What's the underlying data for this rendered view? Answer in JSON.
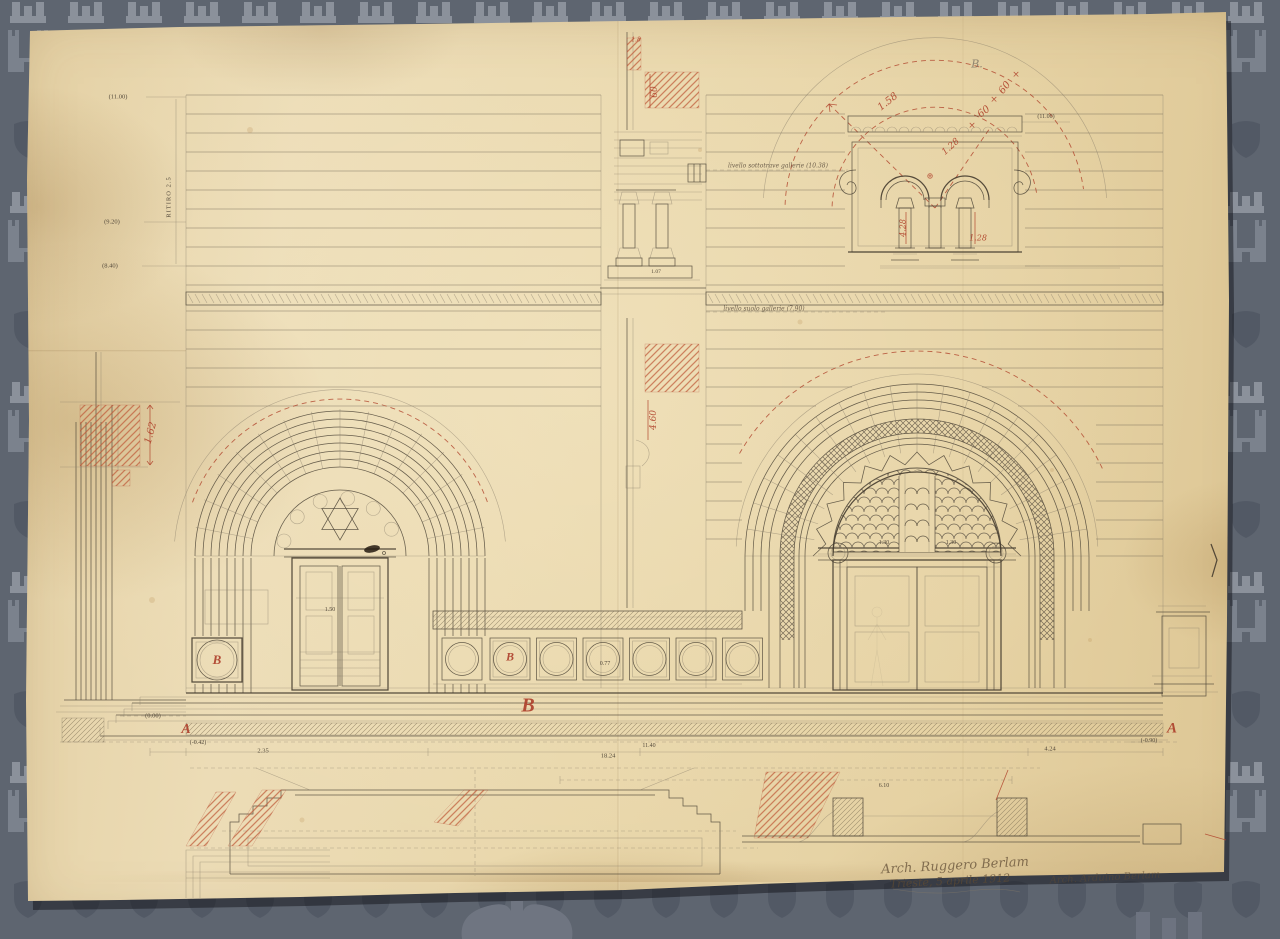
{
  "colors": {
    "backdrop": "#5e6570",
    "watermark_light": "#8b919b",
    "watermark_mid": "#7b828d",
    "watermark_dark": "#525965",
    "paper": "#e9d7ab",
    "ink": "#4e4537",
    "red_ink": "#b0432c",
    "pencil": "#857a68"
  },
  "annotations": [
    {
      "id": "level-11-00-left",
      "t": "(11.00)",
      "x": 118,
      "y": 97,
      "k": "level"
    },
    {
      "id": "ritiro-note",
      "t": "RITIRO 2.5",
      "x": 169,
      "y": 197,
      "k": "level",
      "r": -90,
      "ls": 1
    },
    {
      "id": "level-9-20",
      "t": "(9.20)",
      "x": 112,
      "y": 222,
      "k": "level"
    },
    {
      "id": "level-8-40-left",
      "t": "(8.40)",
      "x": 110,
      "y": 266,
      "k": "level"
    },
    {
      "id": "dim-1-62",
      "t": "1.62",
      "x": 151,
      "y": 433,
      "k": "red",
      "r": -75,
      "s": 10
    },
    {
      "id": "level-0-00",
      "t": "(0.00)",
      "x": 153,
      "y": 716,
      "k": "level"
    },
    {
      "id": "section-letter-a-left",
      "t": "A",
      "x": 186,
      "y": 730,
      "k": "letter",
      "s": 14
    },
    {
      "id": "level-minus-0-42",
      "t": "(-0.42)",
      "x": 198,
      "y": 743,
      "k": "level",
      "s": 6
    },
    {
      "id": "dim-2-35",
      "t": "2.35",
      "x": 263,
      "y": 751,
      "k": "level"
    },
    {
      "id": "dim-18-24",
      "t": "18.24",
      "x": 608,
      "y": 756,
      "k": "level"
    },
    {
      "id": "dim-11-40",
      "t": "11.40",
      "x": 649,
      "y": 746,
      "k": "level",
      "s": 6
    },
    {
      "id": "dim-4-24",
      "t": "4.24",
      "x": 1050,
      "y": 749,
      "k": "level"
    },
    {
      "id": "level-minus-0-90",
      "t": "(-0.90)",
      "x": 1149,
      "y": 741,
      "k": "level",
      "s": 6
    },
    {
      "id": "section-letter-a-right",
      "t": "A",
      "x": 1172,
      "y": 729,
      "k": "letter",
      "s": 15
    },
    {
      "id": "zone-letter-b-large",
      "t": "B",
      "x": 528,
      "y": 706,
      "k": "letter",
      "s": 20
    },
    {
      "id": "medallion-letter-b",
      "t": "B",
      "x": 510,
      "y": 657,
      "k": "letter",
      "s": 12
    },
    {
      "id": "medallion-letter-b-left",
      "t": "B",
      "x": 217,
      "y": 660,
      "k": "letter",
      "s": 13
    },
    {
      "id": "detail-label-b",
      "t": "B.",
      "x": 977,
      "y": 64,
      "k": "pencil",
      "s": 11
    },
    {
      "id": "dim-1-58",
      "t": "1.58",
      "x": 888,
      "y": 102,
      "k": "red",
      "r": -38,
      "s": 10
    },
    {
      "id": "dim-60-upper",
      "t": "60",
      "x": 1005,
      "y": 88,
      "k": "red",
      "r": -52,
      "s": 10
    },
    {
      "id": "dim-60-lower",
      "t": "60",
      "x": 984,
      "y": 112,
      "k": "red",
      "r": -38,
      "s": 10
    },
    {
      "id": "dim-1-28-radial",
      "t": "1.28",
      "x": 951,
      "y": 147,
      "k": "red",
      "r": -42,
      "s": 9
    },
    {
      "id": "dim-1-28-column",
      "t": "1.28",
      "x": 978,
      "y": 238,
      "k": "red",
      "s": 8
    },
    {
      "id": "dim-4-28-column",
      "t": "4.28",
      "x": 903,
      "y": 228,
      "k": "red",
      "r": -90,
      "s": 8
    },
    {
      "id": "level-11-00-right",
      "t": "(11.00)",
      "x": 1046,
      "y": 117,
      "k": "level",
      "s": 6
    },
    {
      "id": "note-livello-sottotrave",
      "t": "livello sottotrave gallerie (10.38)",
      "x": 778,
      "y": 166,
      "k": "note"
    },
    {
      "id": "note-livello-suolo",
      "t": "livello suolo gallerie (7.90)",
      "x": 764,
      "y": 309,
      "k": "note"
    },
    {
      "id": "dim-4-60",
      "t": "4.60",
      "x": 654,
      "y": 420,
      "k": "red",
      "r": -90,
      "s": 9
    },
    {
      "id": "dim-60-section",
      "t": "60",
      "x": 655,
      "y": 92,
      "k": "red",
      "r": -90,
      "s": 9
    },
    {
      "id": "dim-1-8-section",
      "t": "1.8",
      "x": 636,
      "y": 40,
      "k": "red",
      "s": 6
    },
    {
      "id": "dim-1-30-left",
      "t": "1.30",
      "x": 884,
      "y": 543,
      "k": "level",
      "s": 6
    },
    {
      "id": "dim-1-30-right",
      "t": "1.30",
      "x": 951,
      "y": 543,
      "k": "level",
      "s": 6
    },
    {
      "id": "dim-0-77",
      "t": "0.77",
      "x": 605,
      "y": 664,
      "k": "level",
      "s": 6
    },
    {
      "id": "dim-6-10",
      "t": "6.10",
      "x": 884,
      "y": 786,
      "k": "level",
      "s": 6
    },
    {
      "id": "dim-1-07",
      "t": "1.07",
      "x": 656,
      "y": 272,
      "k": "level",
      "s": 5.5
    },
    {
      "id": "dim-1-50-door",
      "t": "1.50",
      "x": 330,
      "y": 610,
      "k": "level",
      "s": 6
    },
    {
      "id": "cross-mark-1",
      "t": "×",
      "x": 1016,
      "y": 75,
      "k": "mark"
    },
    {
      "id": "cross-mark-2",
      "t": "×",
      "x": 994,
      "y": 100,
      "k": "mark"
    },
    {
      "id": "cross-mark-3",
      "t": "×",
      "x": 972,
      "y": 126,
      "k": "mark"
    },
    {
      "id": "center-mark",
      "t": "⊕",
      "x": 930,
      "y": 176,
      "k": "mark",
      "s": 8
    },
    {
      "id": "signature-architect",
      "t": "Arch. Ruggero Berlam",
      "x": 955,
      "y": 866,
      "k": "hand",
      "r": -3,
      "s": 13
    },
    {
      "id": "signature-date",
      "t": "Trieste, 5 aprile 1912",
      "x": 950,
      "y": 881,
      "k": "hand",
      "r": -3,
      "s": 11
    },
    {
      "id": "signature-architect-2",
      "t": "Arch. Arduino Berlam",
      "x": 1105,
      "y": 878,
      "k": "hand",
      "r": -3,
      "s": 10,
      "o": 0.5
    }
  ]
}
